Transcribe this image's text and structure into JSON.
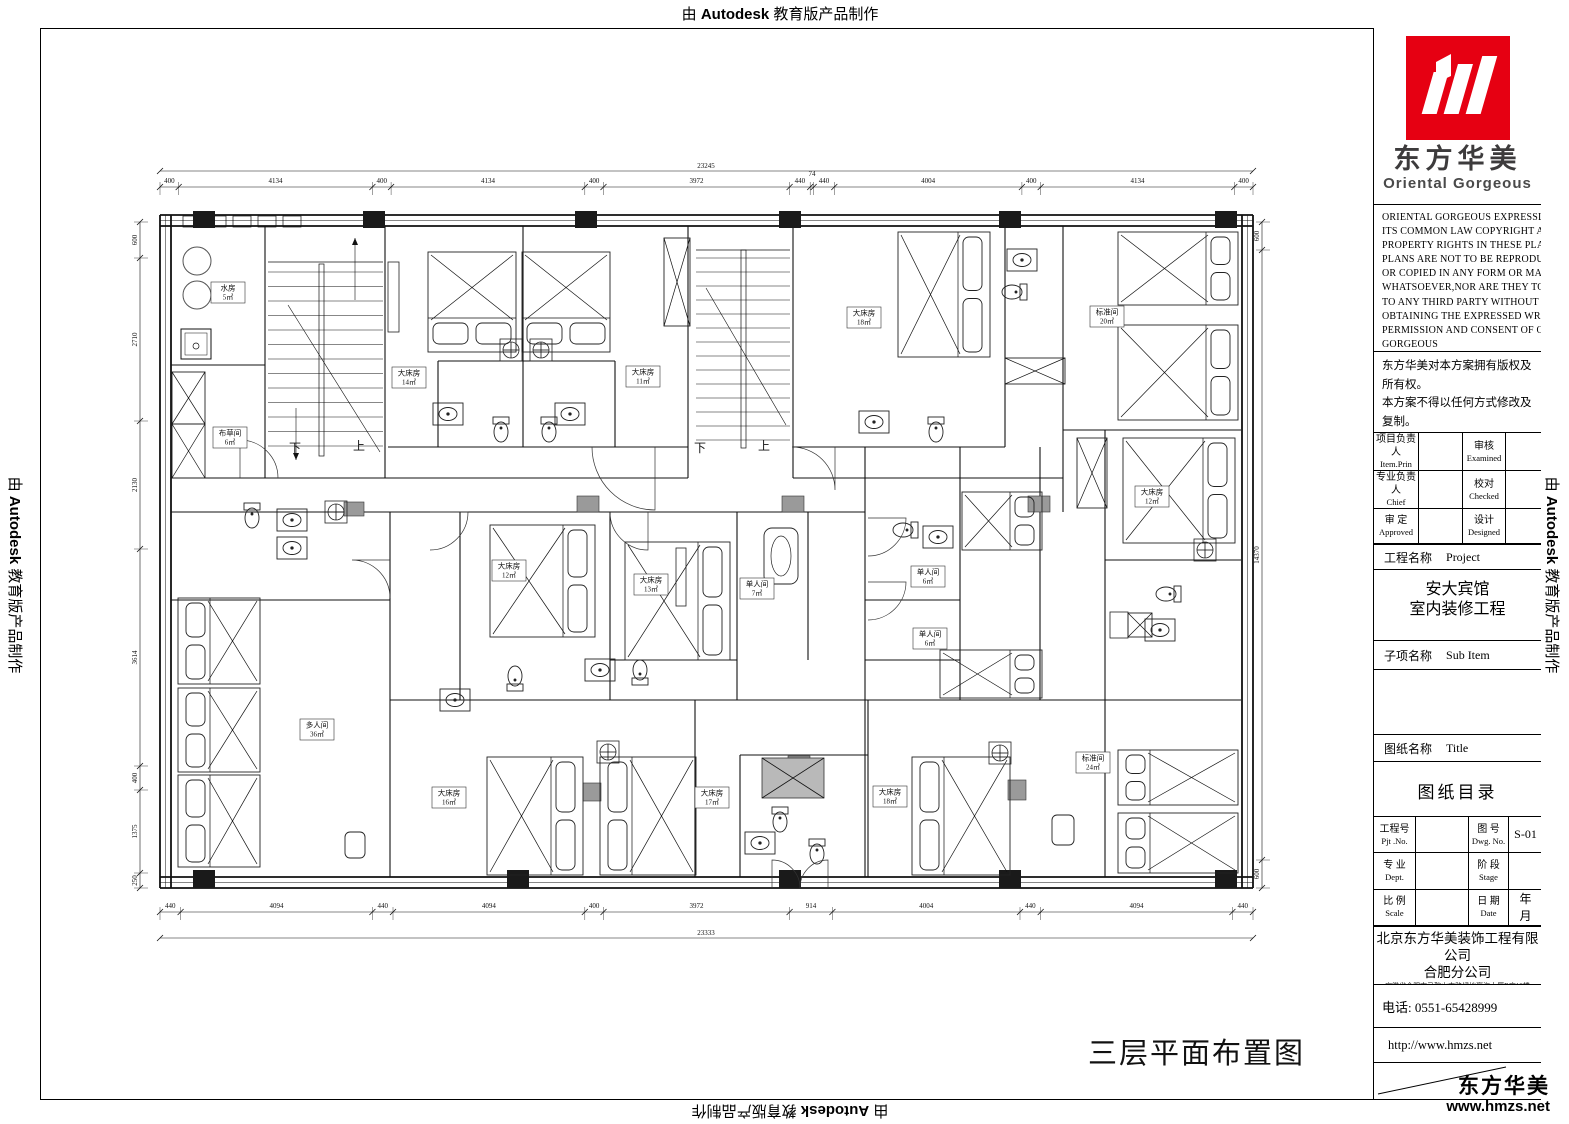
{
  "watermark": {
    "prefix": "由 ",
    "brand": "Autodesk",
    "suffix": " 教育版产品制作"
  },
  "title_block": {
    "logo": {
      "cn": "东方华美",
      "en": "Oriental Gorgeous"
    },
    "copyright_en_lines": [
      "ORIENTAL GORGEOUS EXPRESSLY RESERVES",
      "ITS COMMON LAW COPYRIGHT AND OTHER",
      "PROPERTY RIGHTS IN THESE PLANS.THESE",
      "PLANS ARE NOT TO BE REPRODUCED CHANGED",
      "OR COPIED IN ANY FORM OR MANNER",
      "WHATSOEVER,NOR ARE THEY TO BE ASSIGHED",
      "TO ANY THIRD PARTY WITHOUT FIRST",
      "OBTAINING THE EXPRESSED WRITTEN",
      "PERMISSION AND CONSENT OF ORIENTAL",
      "GORGEOUS"
    ],
    "copyright_cn_lines": [
      "东方华美对本方案拥有版权及所有权。",
      "本方案不得以任何方式修改及复制。",
      "未经东方华美书面授权，本方案不得向",
      "任何第三方转让。"
    ],
    "personnel": {
      "item_prin_cn": "项目负责人",
      "item_prin_en": "Item.Prin",
      "examined_cn": "审核",
      "examined_en": "Examined",
      "chief_cn": "专业负责人",
      "chief_en": "Chief",
      "checked_cn": "校对",
      "checked_en": "Checked",
      "approved_cn": "审 定",
      "approved_en": "Approved",
      "designed_cn": "设计",
      "designed_en": "Designed"
    },
    "project_label_cn": "工程名称",
    "project_label_en": "Project",
    "project_name_line1": "安大宾馆",
    "project_name_line2": "室内装修工程",
    "sub_item_label_cn": "子项名称",
    "sub_item_label_en": "Sub Item",
    "sheet_label_cn": "图纸名称",
    "sheet_label_en": "Title",
    "sheet_name": "图纸目录",
    "pjt_no_cn": "工程号",
    "pjt_no_en": "Pjt .No.",
    "dwg_no_cn": "图 号",
    "dwg_no_en": "Dwg. No.",
    "dwg_no_value": "S-01",
    "dept_cn": "专 业",
    "dept_en": "Dept.",
    "stage_cn": "阶 段",
    "stage_en": "Stage",
    "scale_cn": "比 例",
    "scale_en": "Scale",
    "date_cn": "日 期",
    "date_en": "Date",
    "date_value": "年　月",
    "company_line1": "北京东方华美装饰工程有限公司",
    "company_line2": "合肥分公司",
    "company_address": "安徽省合肥市马鞍山南路绿地赢海大厦B座19楼",
    "phone": "电话: 0551-65428999",
    "website": "http://www.hmzs.net",
    "corner_brand_cn": "东方华美",
    "corner_brand_url": "www.hmzs.net"
  },
  "plan": {
    "title": "三层平面布置图",
    "stair_down": "下",
    "stair_up": "上",
    "rooms": [
      {
        "name": "水房",
        "area": "5㎡"
      },
      {
        "name": "布草间",
        "area": "6㎡"
      },
      {
        "name": "大床房",
        "area": "14㎡"
      },
      {
        "name": "大床房",
        "area": "11㎡"
      },
      {
        "name": "大床房",
        "area": "18㎡"
      },
      {
        "name": "标准间",
        "area": "20㎡"
      },
      {
        "name": "大床房",
        "area": "12㎡"
      },
      {
        "name": "大床房",
        "area": "12㎡"
      },
      {
        "name": "大床房",
        "area": "13㎡"
      },
      {
        "name": "单人间",
        "area": "7㎡"
      },
      {
        "name": "单人间",
        "area": "6㎡"
      },
      {
        "name": "单人间",
        "area": "6㎡"
      },
      {
        "name": "多人间",
        "area": "36㎡"
      },
      {
        "name": "大床房",
        "area": "16㎡"
      },
      {
        "name": "大床房",
        "area": "17㎡"
      },
      {
        "name": "大床房",
        "area": "18㎡"
      },
      {
        "name": "标准间",
        "area": "24㎡"
      }
    ],
    "dims": {
      "top_total": "23245",
      "top": [
        "400",
        "4134",
        "400",
        "4134",
        "400",
        "3972",
        "440",
        "74",
        "440",
        "4004",
        "400",
        "4134",
        "400"
      ],
      "bottom": [
        "440",
        "4094",
        "440",
        "4094",
        "400",
        "3972",
        "914",
        "4004",
        "440",
        "4094",
        "440"
      ],
      "bottom_total": "23333",
      "left": [
        "600",
        "2710",
        "2130",
        "3614",
        "400",
        "1375",
        "250"
      ],
      "right": [
        "600",
        "14370",
        "600"
      ]
    }
  }
}
